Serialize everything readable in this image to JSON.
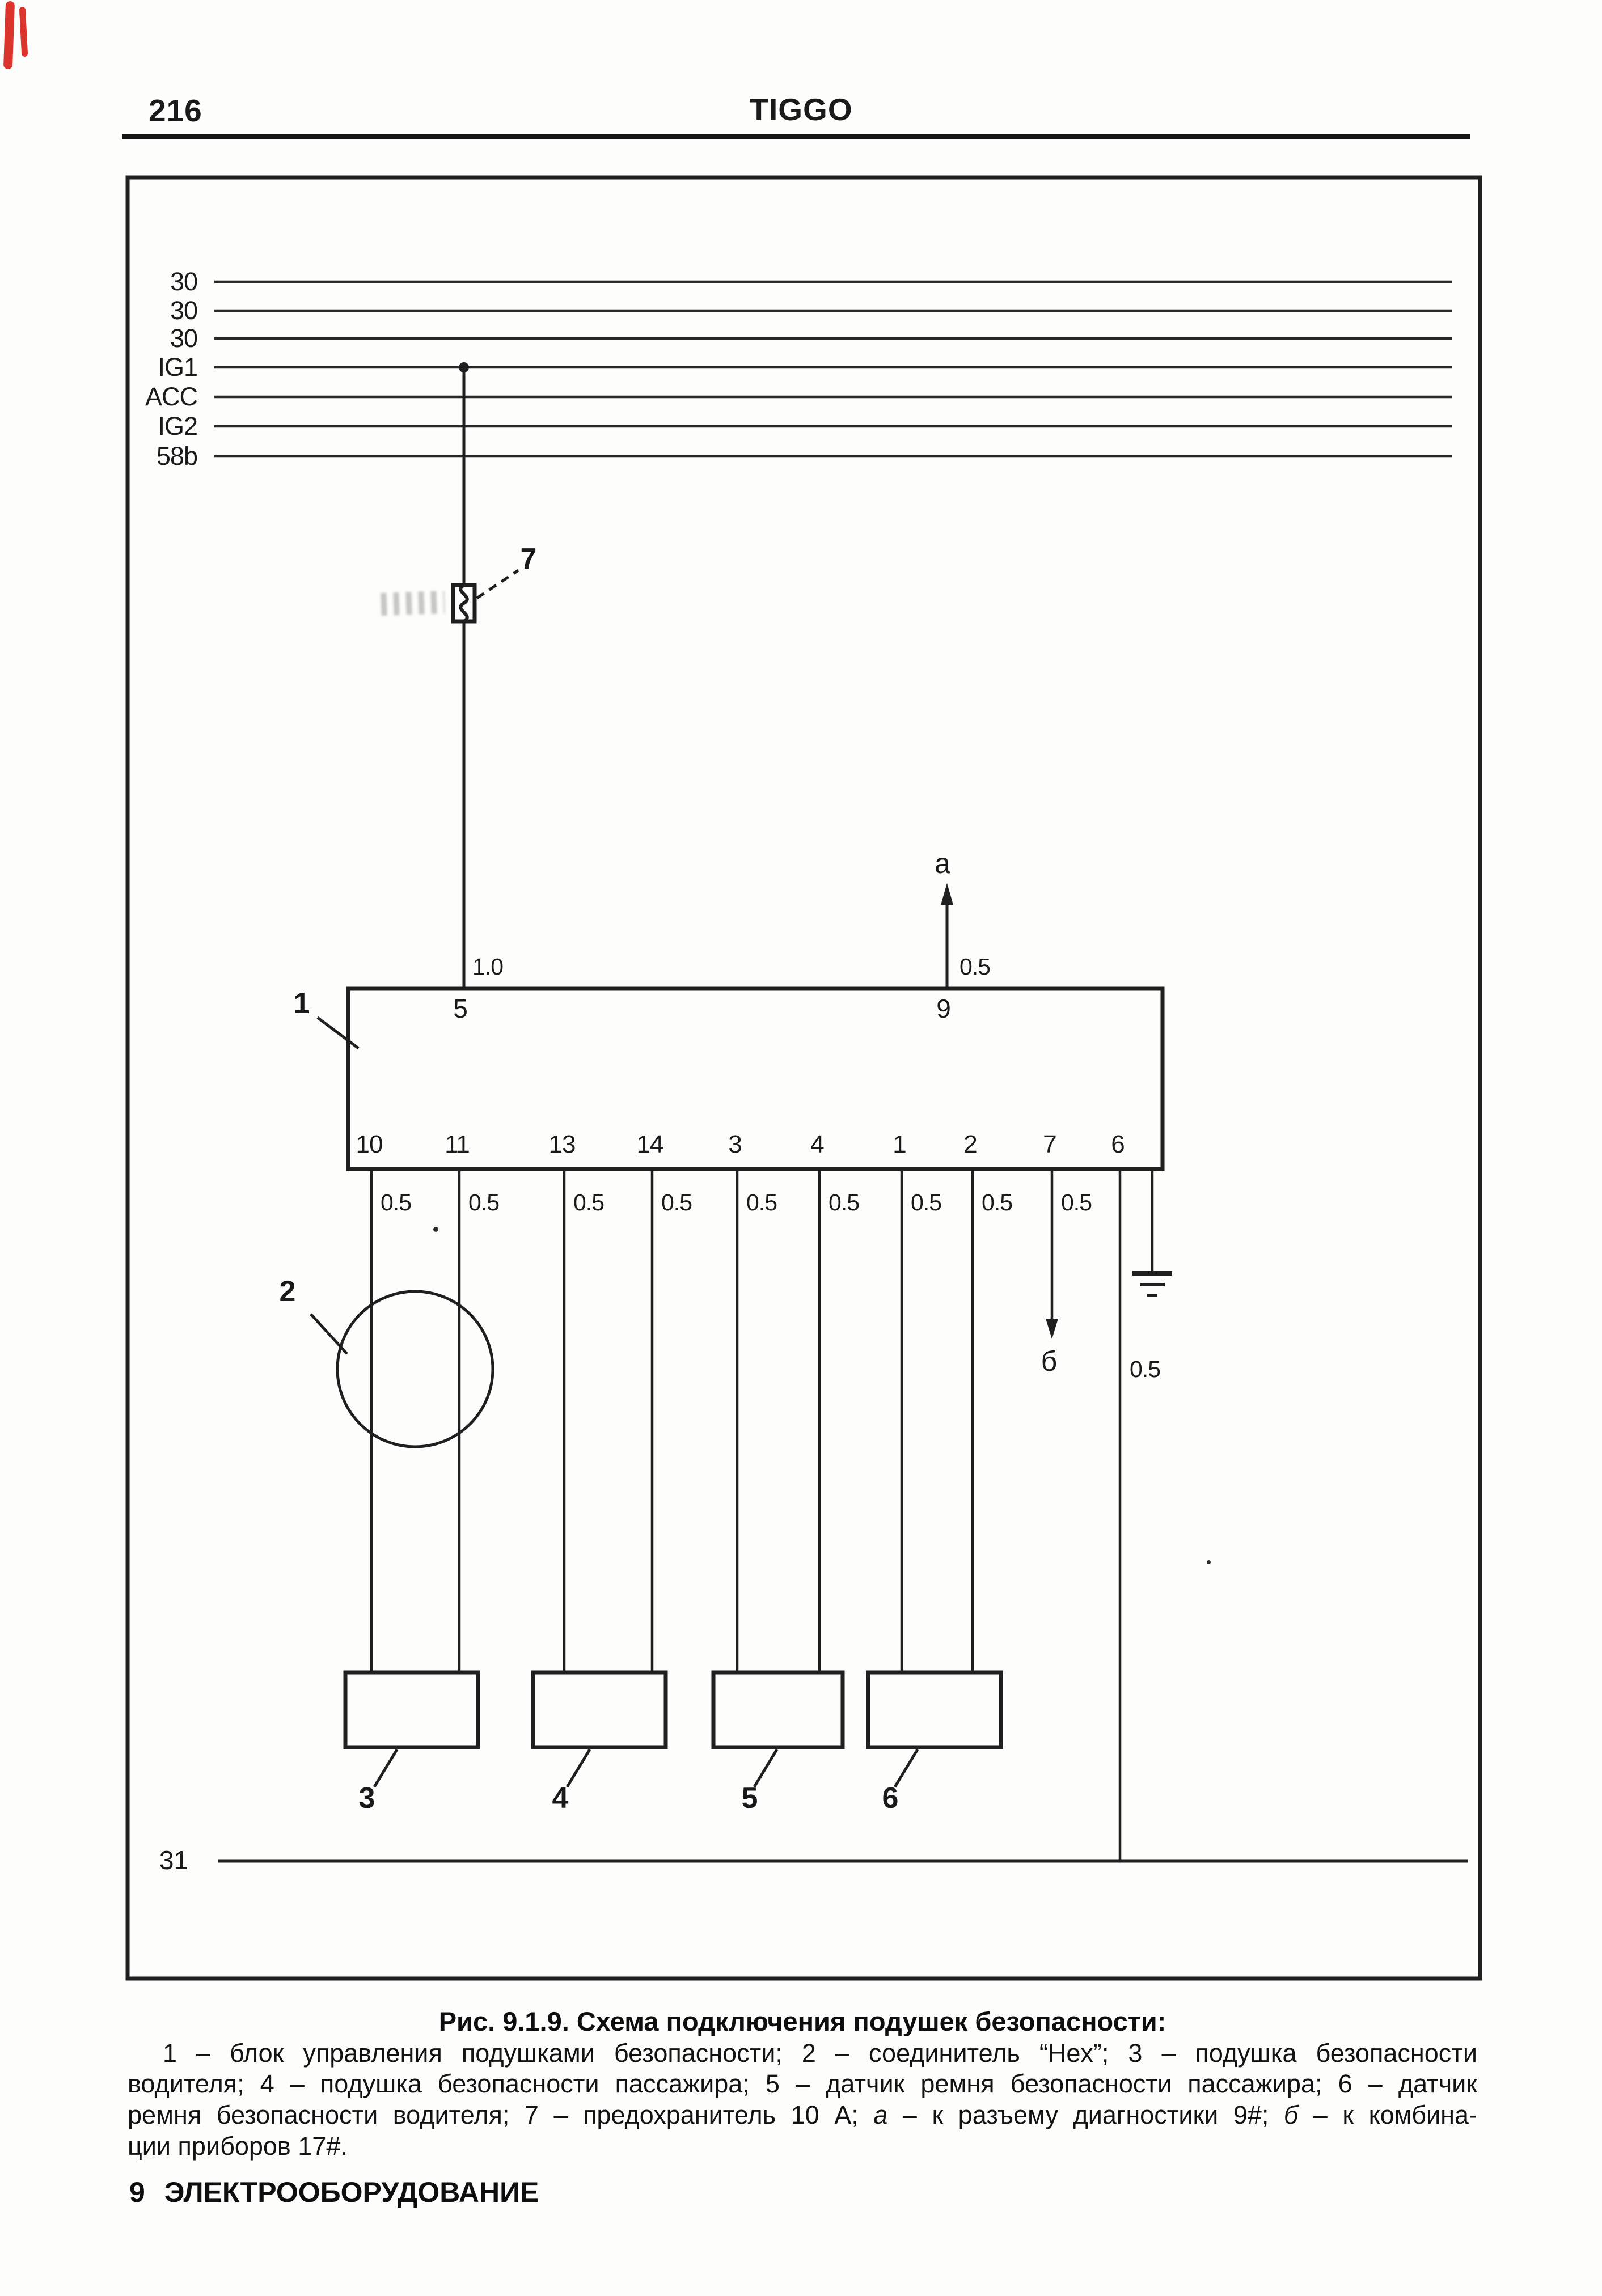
{
  "page": {
    "number": "216",
    "title": "TIGGO"
  },
  "diagram": {
    "bus_labels": [
      "30",
      "30",
      "30",
      "IG1",
      "ACC",
      "IG2",
      "58b"
    ],
    "ground_bus_label": "31",
    "callouts": {
      "block": "1",
      "connector": "2",
      "fuse": "7",
      "driver_airbag": "3",
      "passenger_airbag": "4",
      "passenger_belt_sensor": "5",
      "driver_belt_sensor": "6"
    },
    "top_pins": {
      "pin5": {
        "label": "5",
        "gauge": "1.0"
      },
      "pin9": {
        "label": "9",
        "gauge": "0.5",
        "arrow": "a"
      }
    },
    "bottom_pins": [
      {
        "label": "10",
        "gauge": "0.5"
      },
      {
        "label": "11",
        "gauge": "0.5"
      },
      {
        "label": "13",
        "gauge": "0.5"
      },
      {
        "label": "14",
        "gauge": "0.5"
      },
      {
        "label": "3",
        "gauge": "0.5"
      },
      {
        "label": "4",
        "gauge": "0.5"
      },
      {
        "label": "1",
        "gauge": "0.5"
      },
      {
        "label": "2",
        "gauge": "0.5"
      },
      {
        "label": "7",
        "gauge": "0.5",
        "arrow": "б"
      },
      {
        "label": "6",
        "gauge": "0.5"
      }
    ]
  },
  "caption": {
    "title": "Рис. 9.1.9. Схема подключения подушек безопасности:",
    "line1": "1 – блок управления подушками безопасности; 2 – соединитель “Hex”; 3 – подушка безопасности",
    "line2": "водителя; 4 – подушка безопасности пассажира; 5 – датчик ремня безопасности пассажира; 6 – датчик",
    "line3_pre": "ремня безопасности водителя; 7 – предохранитель 10 А; ",
    "line3_a": "а",
    "line3_a_rest": " – к разъему диагностики 9#; ",
    "line3_b": "б",
    "line3_b_rest": " – к комбина-",
    "line4": "ции приборов 17#."
  },
  "footer": {
    "number": "9",
    "label": "ЭЛЕКТРООБОРУДОВАНИЕ"
  }
}
